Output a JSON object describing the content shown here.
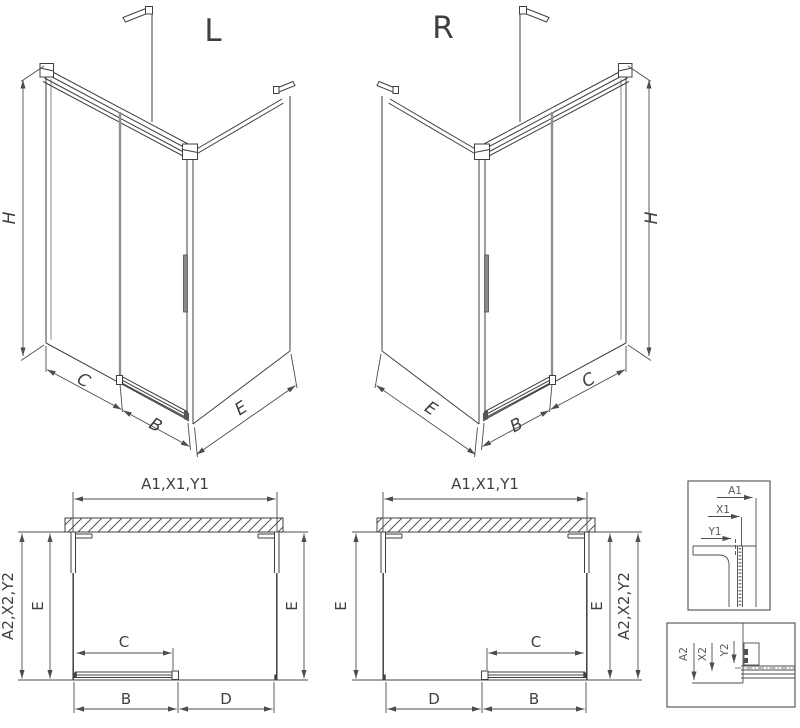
{
  "drawing": {
    "type": "shower-enclosure-technical-drawing",
    "colors": {
      "line": "#3f3f3f",
      "dimension": "#4d4d4d",
      "sliding_panel": "#8f8f8f",
      "handle": "#8a8a8a",
      "background": "#ffffff"
    }
  },
  "iso_left": {
    "title": "L",
    "height_label": "H",
    "fixed_label": "C",
    "door_label": "B",
    "side_label": "E"
  },
  "iso_right": {
    "title": "R",
    "height_label": "H",
    "fixed_label": "C",
    "door_label": "B",
    "side_label": "E"
  },
  "plan_left": {
    "width_label": "A1,X1,Y1",
    "depth_outer_label": "A2,X2,Y2",
    "side_left_label": "E",
    "side_right_label": "E",
    "opening_label": "C",
    "door_label": "B",
    "fixed_label": "D"
  },
  "plan_right": {
    "width_label": "A1,X1,Y1",
    "depth_outer_label": "A2,X2,Y2",
    "side_left_label": "E",
    "side_right_label": "E",
    "opening_label": "C",
    "door_label": "B",
    "fixed_label": "D"
  },
  "detail_wall_profile": {
    "dim_a": "A1",
    "dim_x": "X1",
    "dim_y": "Y1"
  },
  "detail_bottom_rail": {
    "dim_a": "A2",
    "dim_x": "X2",
    "dim_y": "Y2"
  }
}
